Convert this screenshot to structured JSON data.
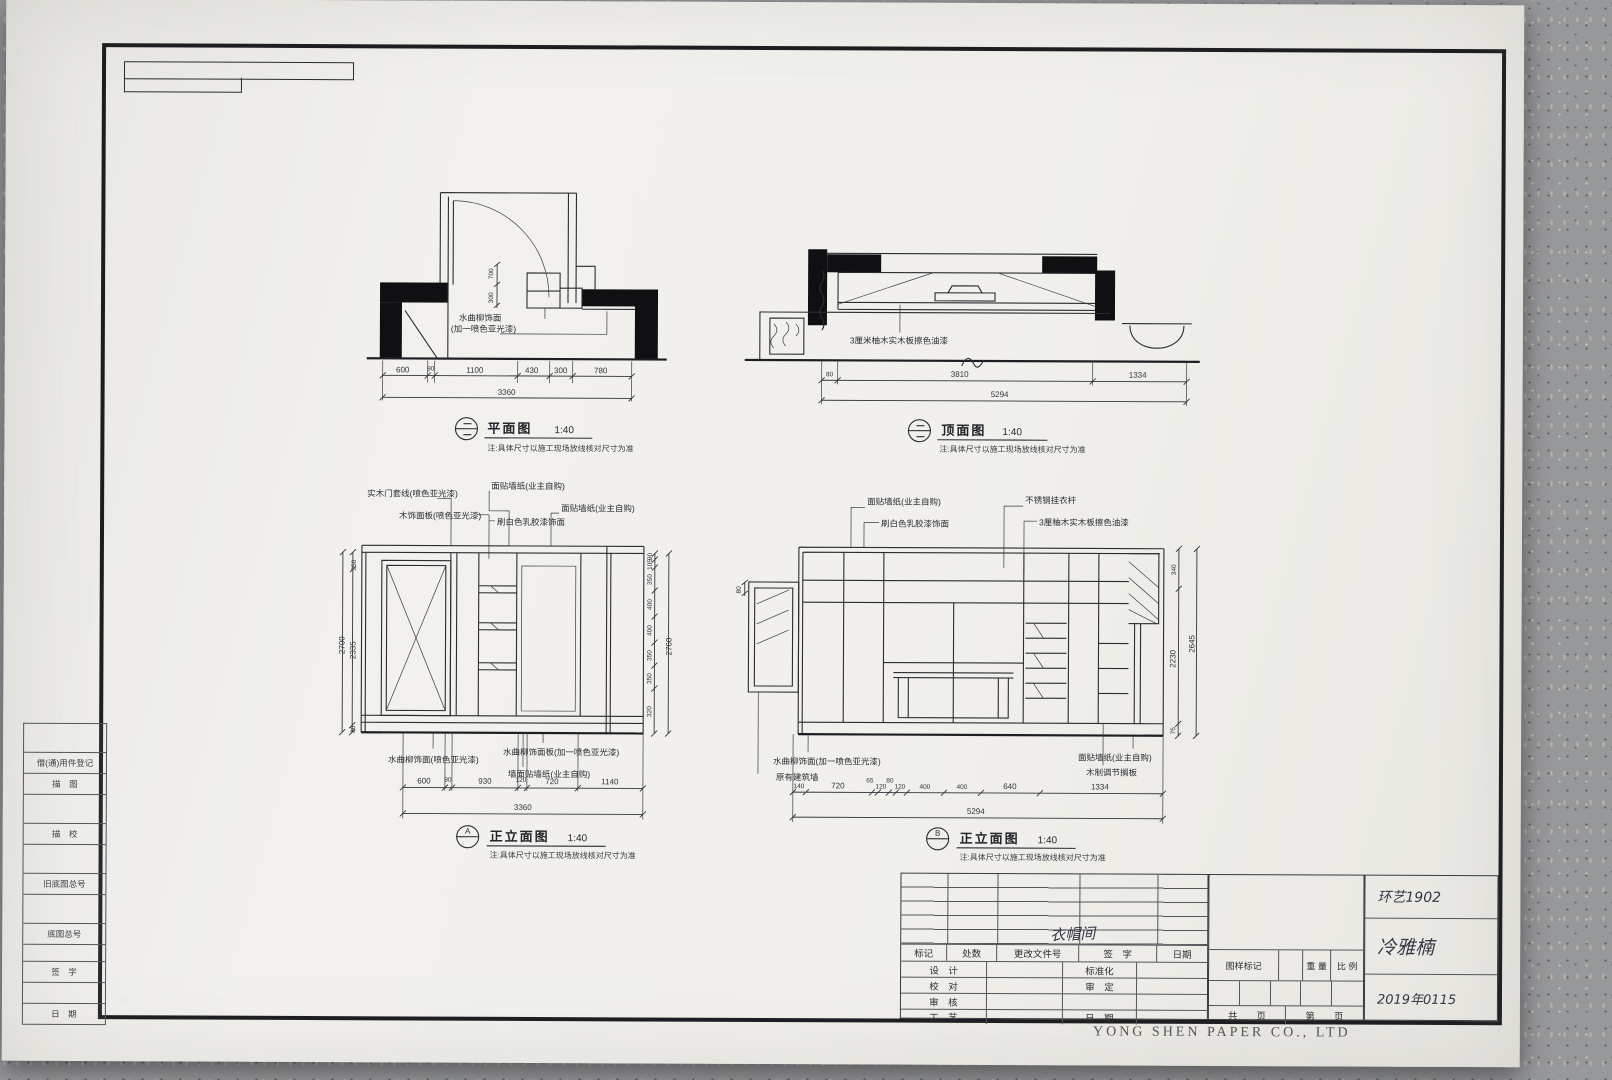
{
  "sheet": {
    "brand": "YONG SHEN PAPER CO., LTD"
  },
  "margin_left": {
    "rows": [
      "",
      "借(通)用件登记",
      "描　图",
      "",
      "描　校",
      "",
      "旧底图总号",
      "",
      "底图总号",
      "",
      "签　字",
      "",
      "日　期"
    ]
  },
  "title_block": {
    "rev_header": [
      "标记",
      "处数",
      "更改文件号",
      "签　字",
      "日期"
    ],
    "row_labels": {
      "design": "设　计",
      "standard": "标准化",
      "check": "校　对",
      "approve": "审　定",
      "review": "审　核",
      "craft": "工　艺",
      "date": "日　期"
    },
    "mark_label": "图样标记",
    "weight_label": "重 量",
    "scale_label": "比 例",
    "pages": [
      "共",
      "页",
      "第",
      "页"
    ],
    "handwritten": {
      "sign": "衣帽间",
      "class_no": "环艺1902",
      "name": "冷雅楠",
      "date": "2019年0115"
    }
  },
  "drawings": {
    "plan_left": {
      "title": "平面图",
      "scale": "1:40",
      "note": "注:具体尺寸以施工现场放线核对尺寸为准",
      "annotation_l1": "水曲柳饰面",
      "annotation_l2": "(加一喷色亚光漆)",
      "dim_v": [
        "700",
        "300"
      ],
      "dims_bottom": [
        "600",
        "90",
        "1100",
        "430",
        "300",
        "780"
      ],
      "dim_total": "3360"
    },
    "plan_right": {
      "title": "顶面图",
      "scale": "1:40",
      "note": "注:具体尺寸以施工现场放线核对尺寸为准",
      "annotation": "3厘米柚木实木板擦色油漆",
      "dims_bottom": [
        "80",
        "3810",
        "1334"
      ],
      "dim_total": "5294"
    },
    "elev_a": {
      "ref": "A",
      "title": "正立面图",
      "scale": "1:40",
      "note": "注:具体尺寸以施工现场放线核对尺寸为准",
      "ann_top": [
        "实木门套线(喷色亚光漆)",
        "木饰面板(喷色亚光漆)",
        "面贴墙纸(业主自购)",
        "刷白色乳胶漆饰面",
        "面贴墙纸(业主自购)"
      ],
      "ann_bottom": [
        "水曲柳饰面(喷色亚光漆)",
        "水曲柳饰面板(加一喷色亚光漆)",
        "墙面贴墙纸(业主自购)"
      ],
      "dims_left": [
        "250",
        "2335",
        "80"
      ],
      "dims_left_total": "2700",
      "dims_right": [
        "90",
        "105",
        "350",
        "400",
        "400",
        "350",
        "350",
        "320"
      ],
      "dims_right_total": "2760",
      "dims_bottom": [
        "600",
        "90",
        "930",
        "120",
        "720",
        "1140"
      ],
      "dim_total": "3360"
    },
    "elev_b": {
      "ref": "B",
      "title": "正立面图",
      "scale": "1:40",
      "note": "注:具体尺寸以施工现场放线核对尺寸为准",
      "ann_top": [
        "面贴墙纸(业主自购)",
        "刷白色乳胶漆饰面",
        "不锈钢挂衣杆",
        "3厘柚木实木板擦色油漆"
      ],
      "ann_bottom_left": [
        "水曲柳饰面(加一喷色亚光漆)",
        "原有建筑墙"
      ],
      "ann_bottom_right": [
        "面贴墙纸(业主自购)",
        "木制调节搁板"
      ],
      "dim_left": "80",
      "dims_right": [
        "340",
        "2230",
        "75"
      ],
      "dims_right_total": "2645",
      "dims_bottom": [
        "140",
        "720",
        "65",
        "120",
        "80",
        "120",
        "400",
        "400",
        "640",
        "1334"
      ],
      "dim_total": "5294"
    }
  }
}
